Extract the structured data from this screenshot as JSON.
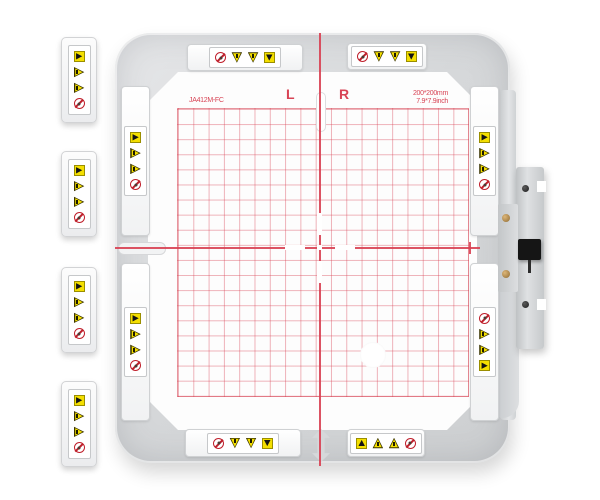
{
  "template_markings": {
    "left_mark": "L",
    "right_mark": "R",
    "model": "JA412M-FC",
    "size_mm": "200*200mm",
    "size_inch": "7.9*7.9inch"
  },
  "colors": {
    "grid_line_pink": "#e88a96",
    "centerline_red": "#d84052",
    "marking_text_red": "#d84455",
    "warning_yellow": "#f4df00",
    "prohibition_red": "#bf1f2b",
    "frame_gray": "#d6d8da",
    "knob_black": "#151515",
    "brass_screw": "#b68c4a"
  },
  "warning_labels": {
    "float1": {
      "icons": [
        "flag-right",
        "warn-right",
        "warn-right",
        "no"
      ]
    },
    "float2": {
      "icons": [
        "flag-right",
        "warn-right",
        "warn-right",
        "no"
      ]
    },
    "float3": {
      "icons": [
        "flag-right",
        "warn-right",
        "warn-right",
        "no"
      ]
    },
    "float4": {
      "icons": [
        "flag-right",
        "warn-right",
        "warn-right",
        "no"
      ]
    },
    "top_left": {
      "icons": [
        "no",
        "warn-down",
        "warn-down",
        "flag-down"
      ]
    },
    "top_right": {
      "icons": [
        "no",
        "warn-down",
        "warn-down",
        "flag-down"
      ]
    },
    "bottom_left": {
      "icons": [
        "no",
        "warn-down",
        "warn-down",
        "flag-down"
      ]
    },
    "bottom_right": {
      "icons": [
        "flag-up",
        "warn-up",
        "warn-up",
        "no"
      ]
    },
    "left_top": {
      "icons": [
        "flag-right",
        "warn-right",
        "warn-right",
        "no"
      ]
    },
    "left_bottom": {
      "icons": [
        "flag-right",
        "warn-right",
        "warn-right",
        "no"
      ]
    },
    "right_top": {
      "icons": [
        "flag-right",
        "warn-right",
        "warn-right",
        "no"
      ]
    },
    "right_bottom": {
      "icons": [
        "no",
        "warn-right",
        "warn-right",
        "flag-right"
      ]
    }
  }
}
